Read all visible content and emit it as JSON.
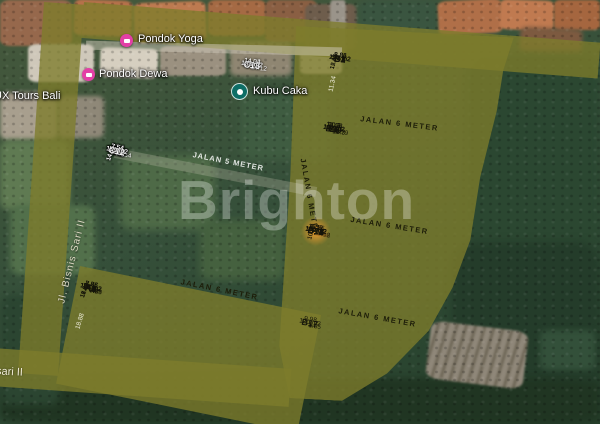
{
  "map": {
    "watermark": "Brighton",
    "pois": [
      {
        "name": "Pondok Yoga",
        "pin_color": "#e33fa6",
        "pin_icon": "lodging"
      },
      {
        "name": "Pondok Dewa",
        "pin_color": "#e33fa6",
        "pin_icon": "lodging"
      },
      {
        "name": "Kubu Caka",
        "pin_color": "#0e6e66",
        "pin_icon": "place-dot"
      },
      {
        "name": "UX Tours Bali",
        "pin_color": null,
        "pin_icon": null
      }
    ],
    "streets": {
      "left_road": "Jl. Bisnis Sari II",
      "bottom_road": "sari II"
    }
  },
  "roads": {
    "label_6m": "JALAN 6 METER",
    "label_5m": "JALAN 5 METER"
  },
  "colors": {
    "plot_fill": "#e0dc4a",
    "road_fill": "#7e7c2c",
    "outline_plot_border": "#ffffff",
    "highlight_circle": "#f89e30",
    "poi_pink": "#e33fa6",
    "poi_teal": "#0e6e66"
  },
  "blocks": {
    "bTop": {
      "style": "filled",
      "leftDim": "11.34",
      "rows": [
        [
          {
            "name": "B1",
            "area": "105 m2",
            "bd": "8.86",
            "side": "12.47",
            "w": 1
          },
          {
            "name": "B2",
            "area": "116 m2",
            "bd": "8.86",
            "side": "12.45",
            "w": 1.05
          },
          {
            "name": "B3",
            "area": "127 m2",
            "bd": "8.85",
            "side": "15.03",
            "w": 1.1
          },
          {
            "name": "B3",
            "area": "216 m2",
            "bd": "8.84",
            "w": 1.55
          }
        ]
      ]
    },
    "bMid": {
      "style": "filled",
      "topDims": [
        "10.3",
        "10.3",
        "11.79"
      ],
      "rows": [
        [
          {
            "name": "B5",
            "area": "103 m2",
            "bd": "10.3",
            "w": 1
          },
          {
            "name": "B6",
            "area": "103 m2",
            "bd": "10.3",
            "w": 1
          },
          {
            "name": "B7",
            "area": "110 m2",
            "bd": "11.88",
            "w": 1.12
          }
        ],
        [
          {
            "name": "B8",
            "area": "103 m2",
            "bd": "10.3",
            "w": 1
          },
          {
            "name": "B9",
            "area": "103 m2",
            "bd": "10.3",
            "w": 1
          },
          {
            "name": "B10",
            "area": "131 m2",
            "bd": "14.33",
            "w": 1.12
          }
        ]
      ]
    },
    "bLow": {
      "style": "filled",
      "topDims": [
        "11.12",
        "11.42",
        "11.96"
      ],
      "rows": [
        [
          {
            "name": "B11",
            "area": "100 m2",
            "bd": "9.39",
            "hl": true,
            "w": 1
          },
          {
            "name": "B12",
            "area": "102 m2",
            "bd": "9.39",
            "w": 1
          },
          {
            "name": "B13",
            "area": "102 m2",
            "bd": "13.76",
            "w": 1.05
          }
        ],
        [
          {
            "name": "B14",
            "area": "100 m2",
            "bd": "9.39",
            "side": "10.7",
            "w": 1
          },
          {
            "name": "B15",
            "area": "100 m2",
            "bd": "9.38",
            "side": "10.7",
            "w": 1
          },
          {
            "name": "B16",
            "area": "119 m2",
            "bd": "6.59",
            "w": 1.05
          }
        ]
      ]
    },
    "b17": {
      "style": "filled",
      "topDims": [
        "9.9",
        "14.5"
      ],
      "rows": [
        [
          {
            "name": "B17",
            "area": "120 m2",
            "bd": "9.98",
            "w": 1
          },
          {
            "name": "B18",
            "area": "116 m2",
            "bd": "5.72",
            "clip": true,
            "w": 1.1
          }
        ]
      ]
    },
    "cMain": {
      "style": "outline",
      "topDims": [
        "13.54",
        "7.5",
        "7.5",
        "7.5",
        "7.5",
        "7.5"
      ],
      "rows": [
        [
          {
            "name": "C1",
            "area": "185 m2",
            "bd": "13.2",
            "w": 1.5
          },
          {
            "name": "C2",
            "area": "109 m2",
            "bd": "7.54",
            "w": 1
          },
          {
            "name": "C3",
            "area": "109 m2",
            "bd": "7.54",
            "w": 1
          },
          {
            "name": "C4",
            "area": "109 m2",
            "bd": "7.54",
            "w": 1
          },
          {
            "name": "C5",
            "area": "109 m2",
            "bd": "7.54",
            "w": 1
          },
          {
            "name": "C6",
            "area": "109 m2",
            "bd": "7.54",
            "w": 1
          }
        ],
        [
          {
            "name": "C7",
            "area": "112 m2",
            "bd": "7.54",
            "w": 1.5
          },
          {
            "name": "C8",
            "area": "109 m2",
            "bd": "7.54",
            "side": "14.55",
            "w": 1
          },
          {
            "name": "C9",
            "area": "109 m2",
            "bd": "7.54",
            "side": "14.55",
            "w": 1
          },
          {
            "name": "C10",
            "area": "109 m2",
            "bd": "7.54",
            "side": "14.55",
            "w": 1
          },
          {
            "name": "C11",
            "area": "109 m2",
            "bd": "7.54",
            "side": "14.55",
            "w": 1
          },
          {
            "name": "C12",
            "area": "109 m2",
            "bd": "7.54",
            "side": "14.55",
            "w": 1
          }
        ]
      ]
    },
    "cCol": {
      "style": "outline",
      "column": true,
      "areaFirst": true,
      "topDims": [
        "14.12"
      ],
      "rows": [
        [
          {
            "name": "C15",
            "area": "124 m2",
            "w": 1
          }
        ],
        [
          {
            "name": "C14",
            "area": "135 m2",
            "bd": "14.32",
            "w": 1
          }
        ],
        [
          {
            "name": "C13",
            "area": "137 m2",
            "bd": "14.04",
            "w": 1
          }
        ]
      ]
    },
    "aRow": {
      "style": "filled",
      "leftDim": "18.88",
      "topDims": [
        "9.86",
        "7.8",
        "7.7",
        "7.7",
        "7.8",
        "8.29"
      ],
      "rows": [
        [
          {
            "name": "A1",
            "area": "165 m2",
            "bd": "8.65",
            "side": "17.62",
            "w": 1.12
          },
          {
            "name": "A2",
            "area": "133 m2",
            "bd": "7.86",
            "side": "16.62",
            "w": 1
          },
          {
            "name": "A3",
            "area": "122 m2",
            "bd": "7.76",
            "side": "15.62",
            "w": 0.97
          },
          {
            "name": "A4",
            "area": "114 m2",
            "bd": "7.76",
            "side": "14.52",
            "w": 0.97
          },
          {
            "name": "A5",
            "area": "107 m2",
            "bd": "7.86",
            "side": "13.22",
            "w": 1
          },
          {
            "name": "A6",
            "area": "104 m2",
            "bd": "8.36",
            "side": "12.56",
            "w": 1.02
          }
        ]
      ]
    }
  }
}
